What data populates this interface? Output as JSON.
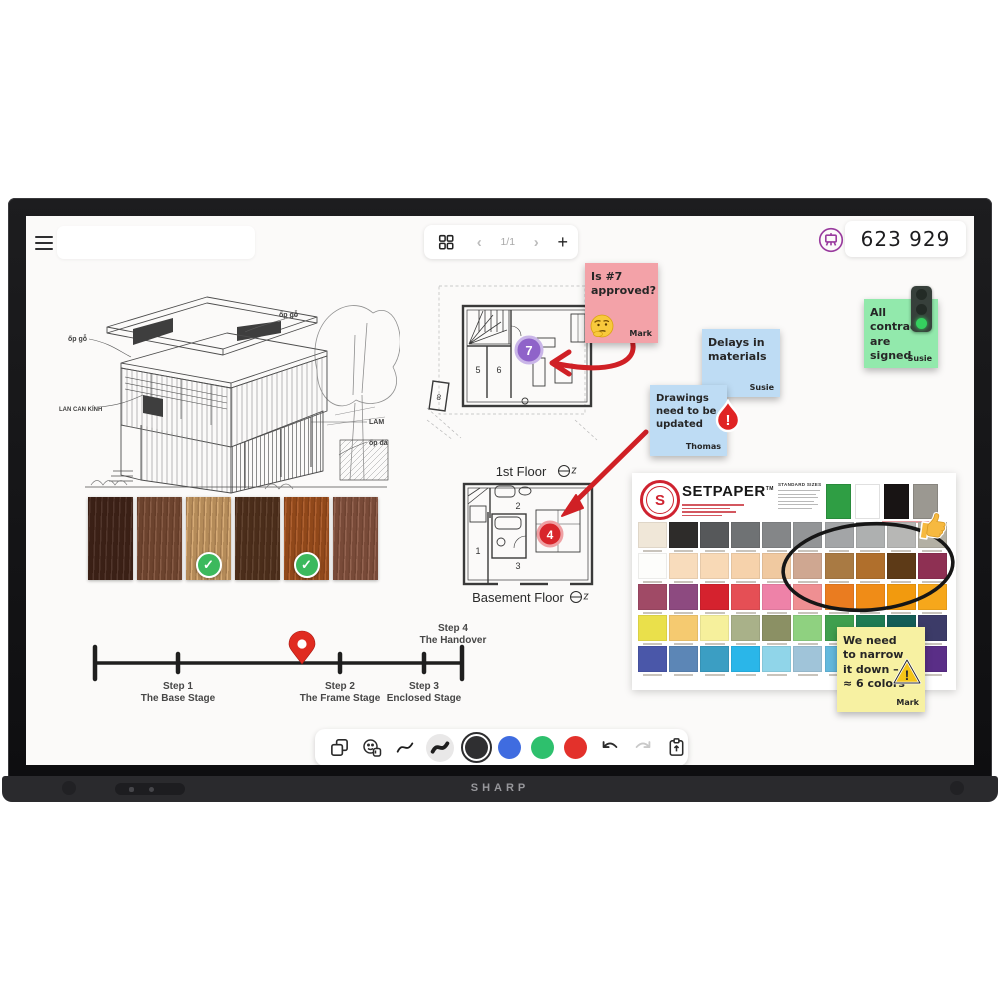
{
  "header": {
    "session_code": "623 929",
    "page_indicator": "1/1"
  },
  "device": {
    "brand": "SHARP"
  },
  "sticky_notes": {
    "approved": {
      "text": "Is #7 approved?",
      "author": "Mark",
      "color": "#f3a2a8"
    },
    "delays": {
      "text": "Delays in materials",
      "author": "Susie",
      "color": "#bedcf4"
    },
    "drawings": {
      "text": "Drawings need to be updated",
      "author": "Thomas",
      "color": "#bedcf4"
    },
    "contracts": {
      "text": "All contracts are signed",
      "author": "Susie",
      "color": "#92e9ac"
    },
    "narrow": {
      "text": "We need to narrow it down –",
      "text2": "≈ 6 colors",
      "author": "Mark",
      "color": "#f7f1a2"
    }
  },
  "floor_plans": {
    "first": {
      "label": "1st Floor",
      "marker": "7",
      "room_a": "5",
      "room_b": "6",
      "room_c": "8"
    },
    "basement": {
      "label": "Basement Floor",
      "marker": "4",
      "room_a": "1",
      "room_b": "2",
      "room_c": "3"
    }
  },
  "timeline": {
    "steps": [
      {
        "label": "Step 1",
        "sublabel": "The Base Stage"
      },
      {
        "label": "Step 2",
        "sublabel": "The Frame Stage"
      },
      {
        "label": "Step 3",
        "sublabel": "Enclosed Stage"
      },
      {
        "label": "Step 4",
        "sublabel": "The Handover"
      }
    ]
  },
  "sketch": {
    "labels": {
      "wood_left": "ốp gỗ",
      "wood_right": "ốp gỗ",
      "railing": "LAN CAN KÍNH",
      "lam": "LAM",
      "stone": "ốp đá"
    }
  },
  "wood_swatches": [
    {
      "color": "#42251a",
      "check": ""
    },
    {
      "color": "#7d4e36",
      "check": ""
    },
    {
      "color": "#d3a46a",
      "check": "✓"
    },
    {
      "color": "#55341f",
      "check": ""
    },
    {
      "color": "#a8541f",
      "check": "✓"
    },
    {
      "color": "#8b5742",
      "check": ""
    }
  ],
  "color_chart": {
    "brand": "SETPAPER",
    "sizes_heading": "STANDARD SIZES",
    "header_swatches": [
      "#2f9e44",
      "#ffffff",
      "#181414",
      "#9b9891"
    ],
    "row1": [
      "#f0e7d8",
      "#2e2c2a",
      "#56585a",
      "#6f7274",
      "#848688",
      "#939597",
      "#a3a5a7",
      "#aeb0b0",
      "#b7b7b5",
      "#b3b0a4"
    ],
    "row2": [
      "#fdfdfb",
      "#f8dcbc",
      "#f8d9b6",
      "#f6d2ab",
      "#f0c9a0",
      "#cfa791",
      "#a97a43",
      "#b06f2c",
      "#5d3a17",
      "#8e3053"
    ],
    "row3": [
      "#a04a66",
      "#8d4a80",
      "#d5222e",
      "#e54f55",
      "#ee82a8",
      "#ef8f92",
      "#ea7c20",
      "#f08c17",
      "#f29a0e",
      "#f6a71b"
    ],
    "row4": [
      "#eae04b",
      "#f5ca70",
      "#f6f09c",
      "#a9b189",
      "#8b9064",
      "#8fd180",
      "#3f9f4e",
      "#1f7b53",
      "#155d57",
      "#3c3b68"
    ],
    "row5": [
      "#4a57a9",
      "#5c86b6",
      "#3b9ec3",
      "#2ab6e9",
      "#90d5e9",
      "#a0c4d9",
      "#63b9dd",
      "#2f6db4",
      "#15356b",
      "#5a2e87"
    ]
  },
  "toolbar": {
    "pen_colors": [
      "#2f2f31",
      "#3f6ce0",
      "#2ec06d",
      "#e3312b"
    ]
  }
}
